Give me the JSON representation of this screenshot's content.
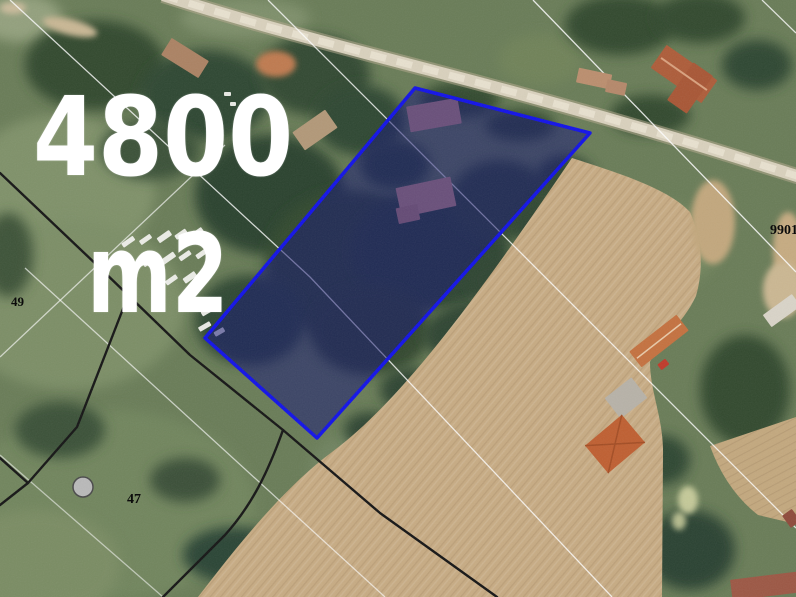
{
  "map": {
    "area_label": {
      "value": "4800",
      "unit": "m2"
    },
    "parcels": [
      {
        "number": "49"
      },
      {
        "number": "47"
      },
      {
        "number": "9901"
      }
    ],
    "overlay": {
      "outline_color": "#1212e8",
      "fill_color": "rgba(20,20,115,0.53)",
      "label_color": "#ffffff"
    }
  }
}
